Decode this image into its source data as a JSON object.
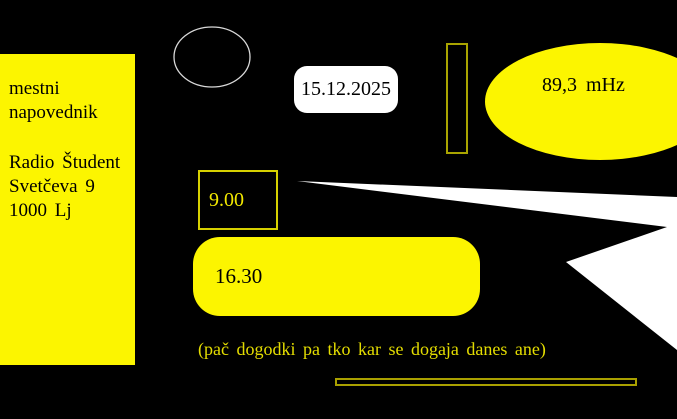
{
  "canvas": {
    "width": 677,
    "height": 419
  },
  "colors": {
    "background": "#000000",
    "bright_yellow": "#fcf500",
    "olive_outline": "#a9a400",
    "box_outline_yellow": "#d6d000",
    "footnote_yellow": "#e4dd00",
    "white": "#ffffff",
    "text_black": "#000000"
  },
  "info_card": {
    "lines": [
      "mestni",
      "napovednik",
      "",
      "Radio Študent",
      "Svetčeva 9",
      "1000 Lj"
    ]
  },
  "date_badge": {
    "label": "15.12.2025"
  },
  "frequency": {
    "label": "89,3 mHz"
  },
  "schedule": {
    "slot1": {
      "time": "9.00"
    },
    "slot2": {
      "time": "16.30"
    }
  },
  "footnote": {
    "text": "(pač dogodki pa tko kar se dogaja danes ane)"
  }
}
